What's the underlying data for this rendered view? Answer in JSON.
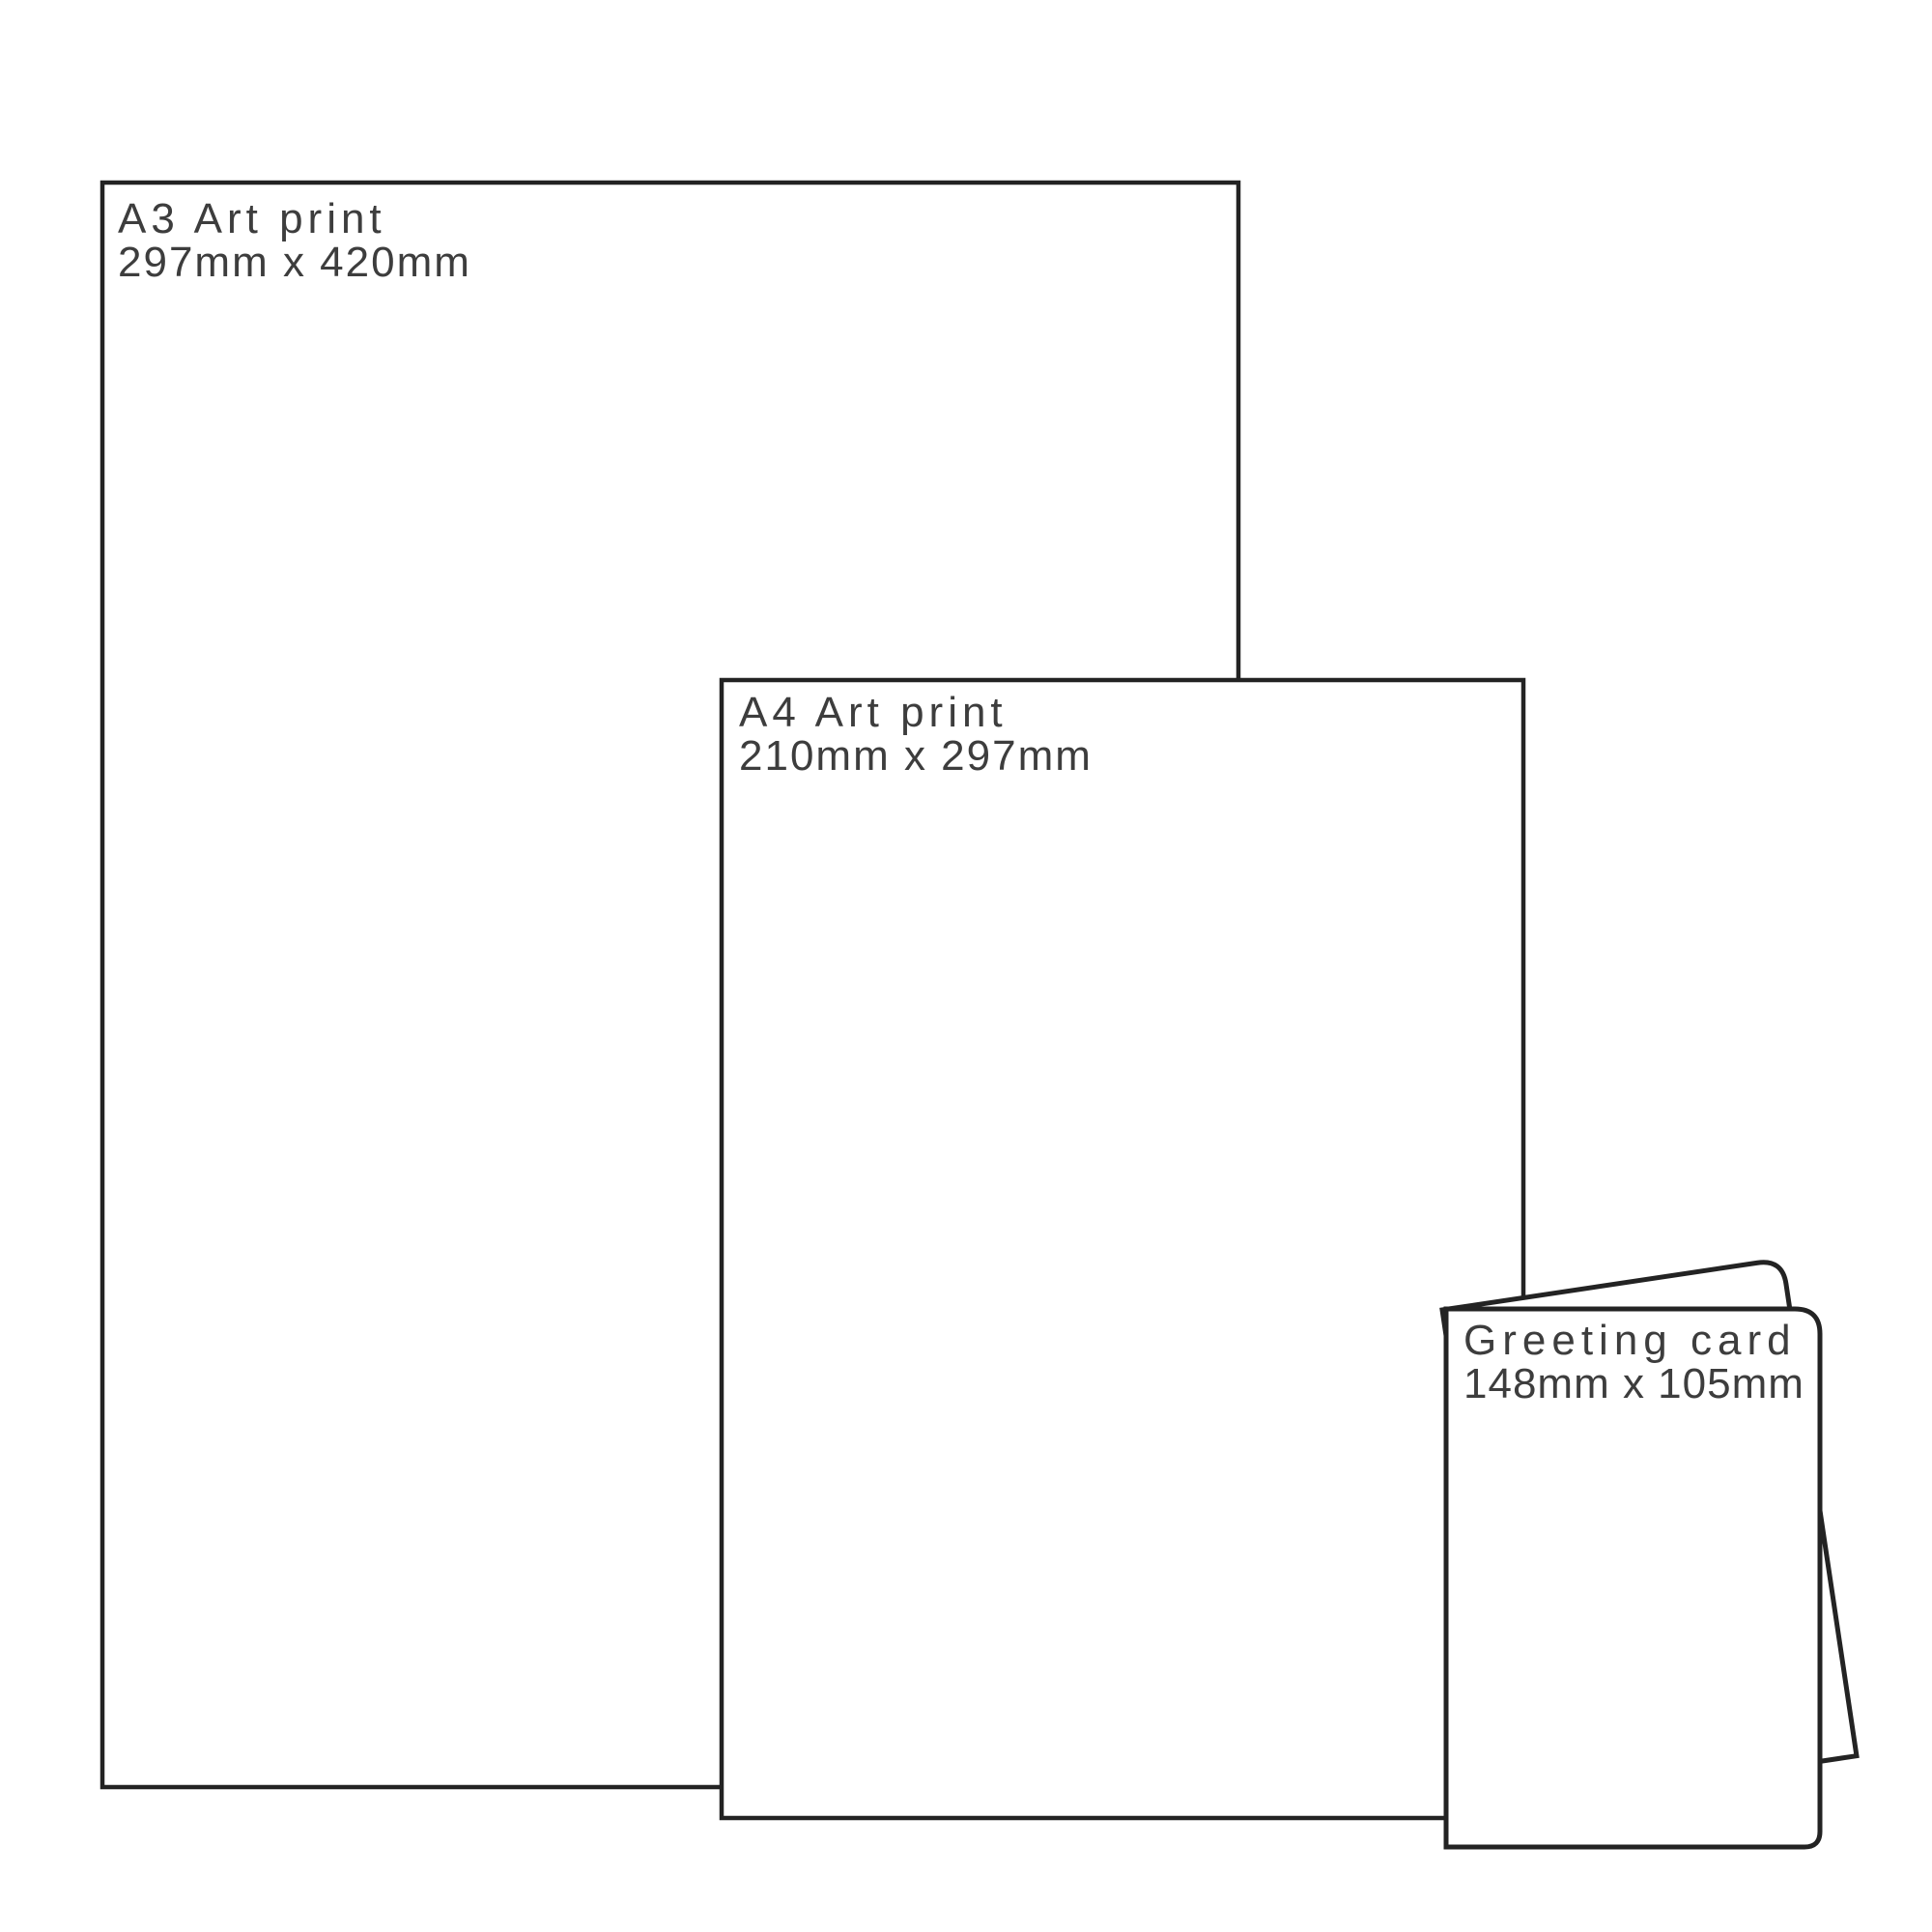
{
  "colors": {
    "stroke": "#232323",
    "text": "#3d3d3d",
    "paper": "#ffffff",
    "background": "#ffffff"
  },
  "items": {
    "a3": {
      "title": "A3 Art print",
      "dimensions": "297mm x 420mm"
    },
    "a4": {
      "title": "A4 Art print",
      "dimensions": "210mm x 297mm"
    },
    "card": {
      "title": "Greeting card",
      "dimensions": "148mm x 105mm"
    }
  }
}
